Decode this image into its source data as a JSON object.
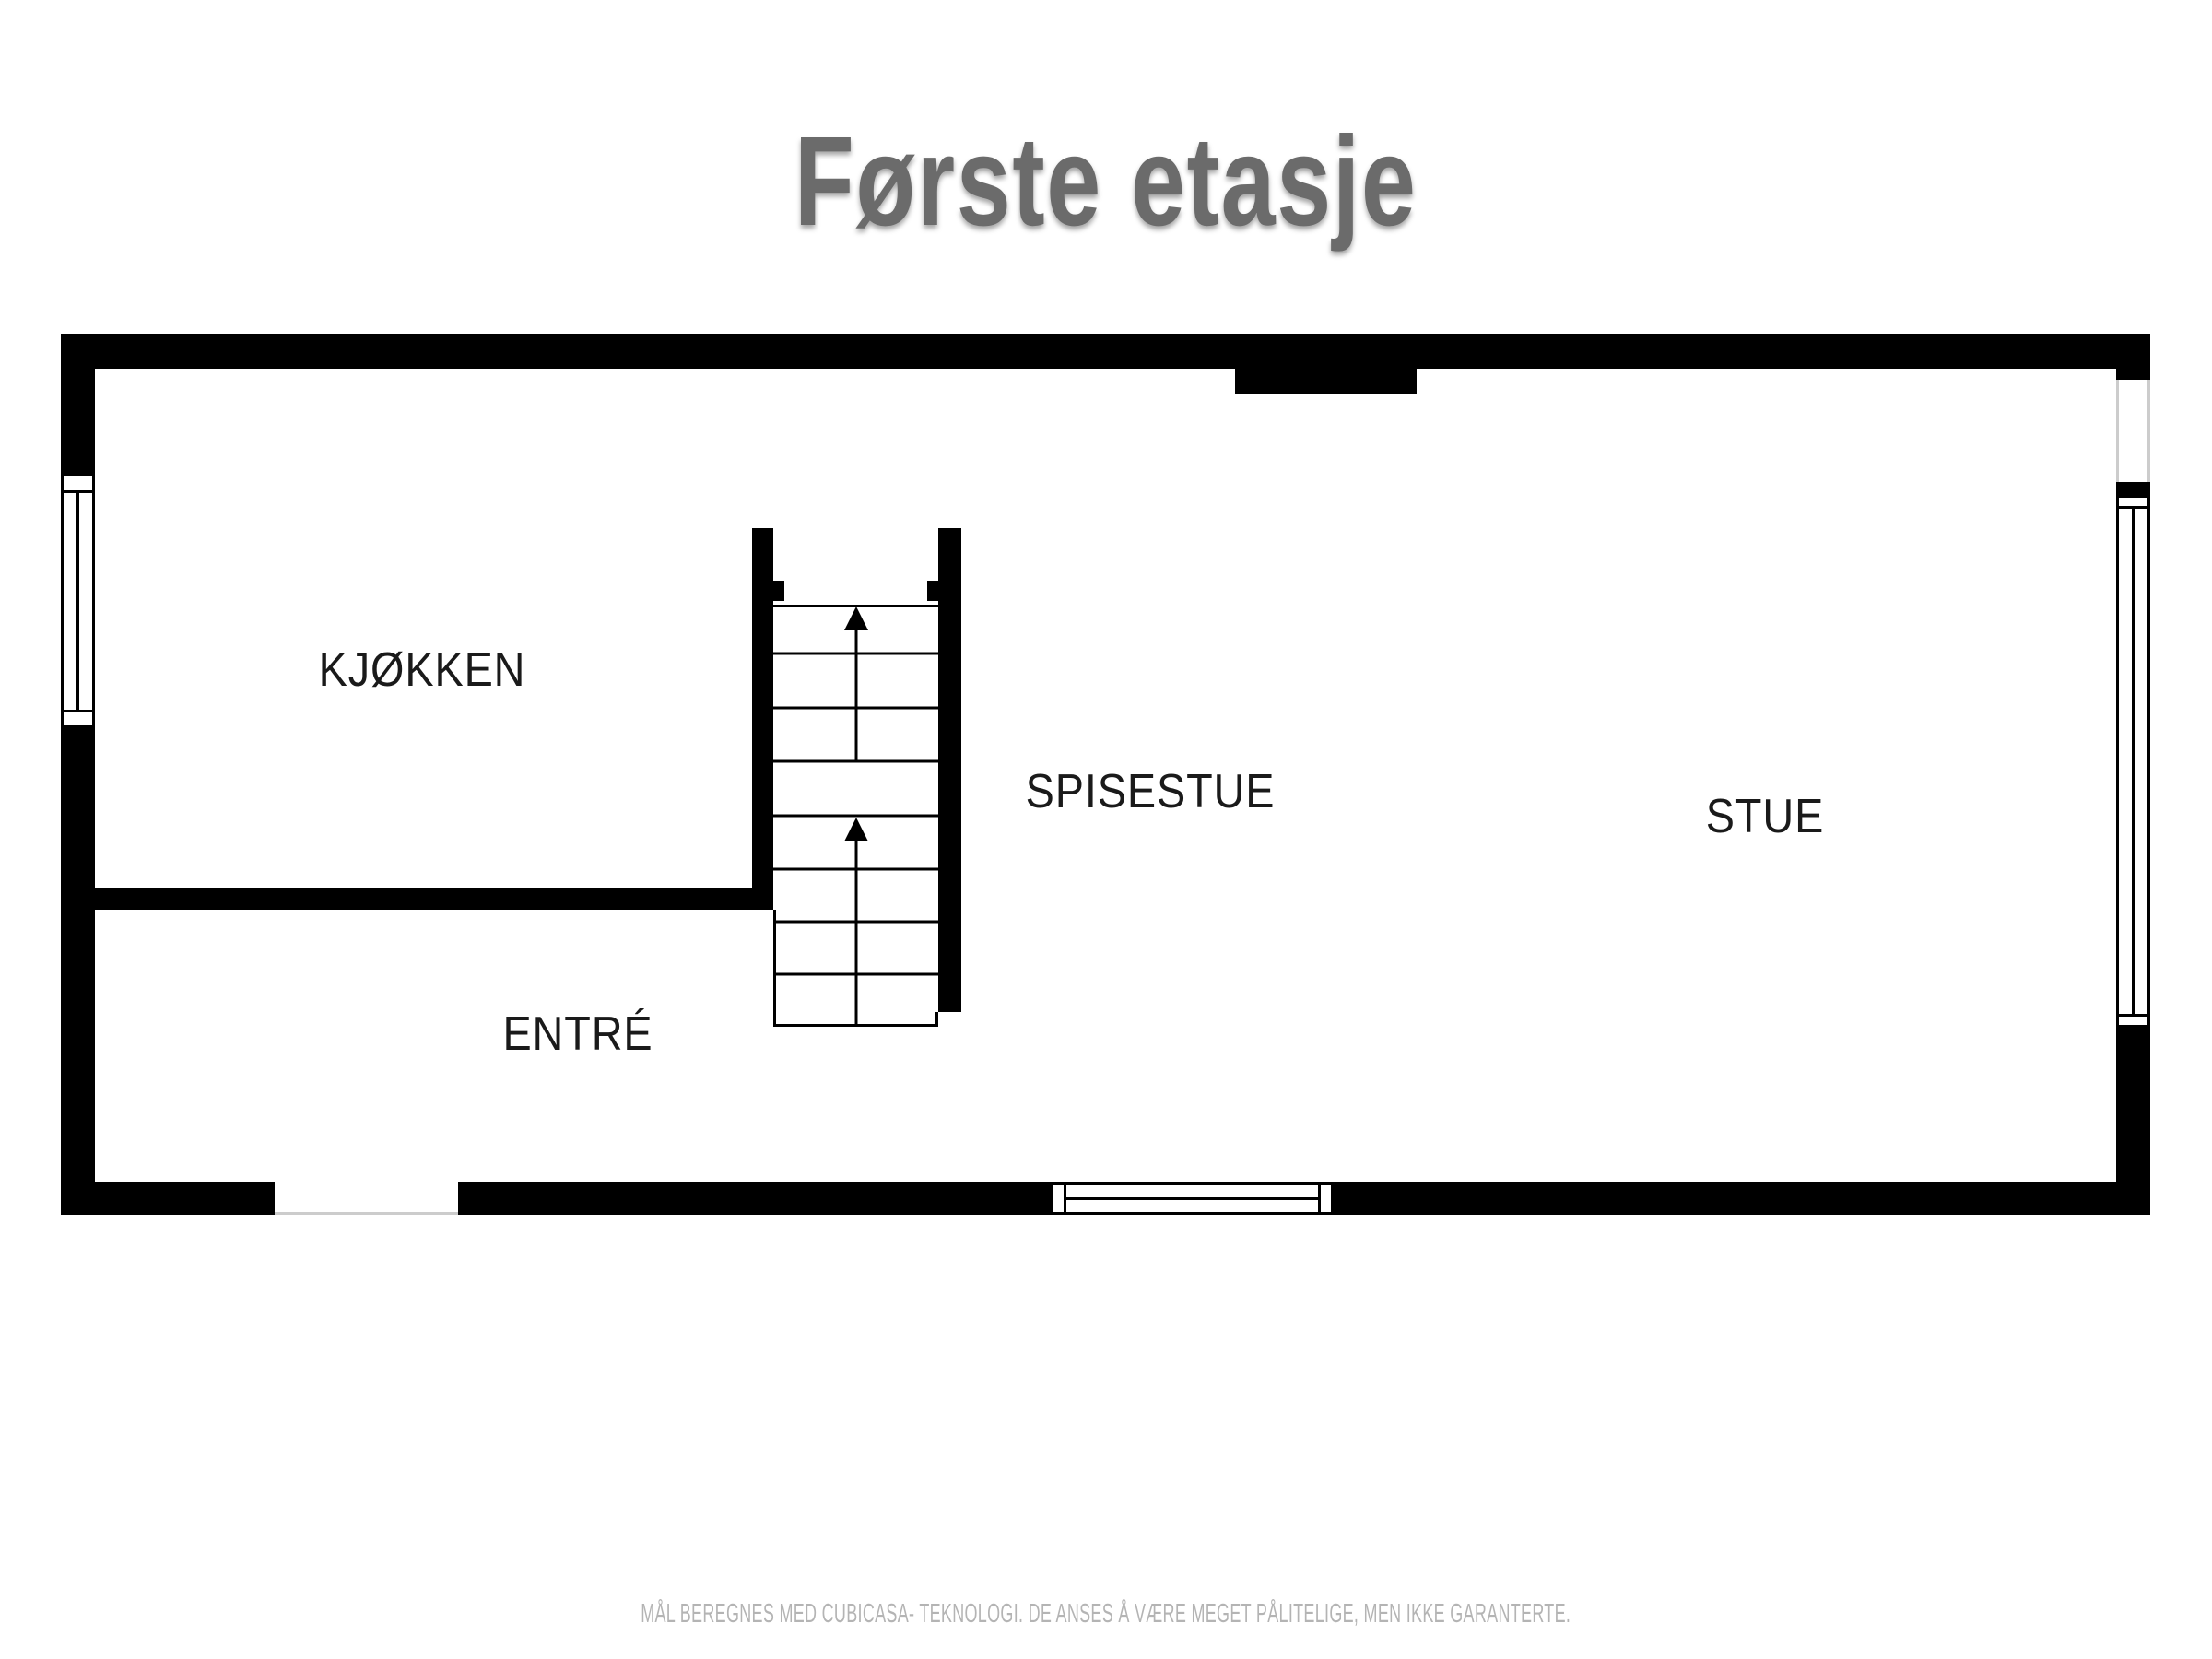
{
  "title": "Første etasje",
  "floor_plan": {
    "rooms": [
      {
        "id": "kjokken",
        "label": "KJØKKEN"
      },
      {
        "id": "spisestue",
        "label": "SPISESTUE"
      },
      {
        "id": "stue",
        "label": "STUE"
      },
      {
        "id": "entre",
        "label": "ENTRÉ"
      }
    ],
    "stairs": {
      "up_arrows": 2,
      "flights": 2
    },
    "windows": 3,
    "door_openings": 2
  },
  "footer": {
    "disclaimer": "MÅL BEREGNES MED CUBICASA- TEKNOLOGI. DE ANSES Å VÆRE MEGET PÅLITELIGE, MEN IKKE GARANTERTE."
  },
  "colors": {
    "wall": "#000000",
    "title_text": "#6b6b6b",
    "room_label": "#1a1a1a",
    "disclaimer_text": "#b4b4b4",
    "opening_line": "#cccccc",
    "background": "#ffffff"
  }
}
